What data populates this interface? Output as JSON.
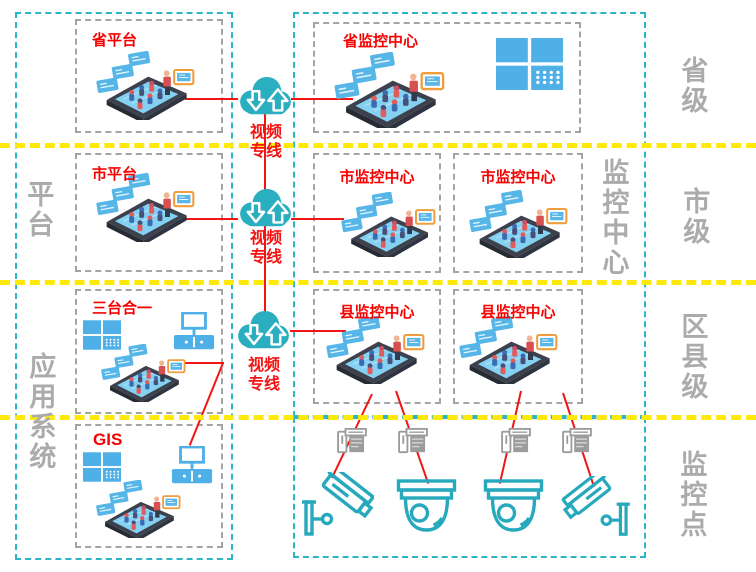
{
  "platform_column": {
    "boxes": [
      {
        "title": "省平台"
      },
      {
        "title": "市平台"
      },
      {
        "title": "三台合一"
      },
      {
        "title": "GIS"
      }
    ]
  },
  "monitoring_column": {
    "boxes": [
      {
        "title": "省监控中心"
      },
      {
        "title": "市监控中心"
      },
      {
        "title": "市监控中心"
      },
      {
        "title": "县监控中心"
      },
      {
        "title": "县监控中心"
      }
    ]
  },
  "video_links": [
    {
      "line1": "视频",
      "line2": "专线"
    },
    {
      "line1": "视频",
      "line2": "专线"
    },
    {
      "line1": "视频",
      "line2": "专线"
    }
  ],
  "side_labels": {
    "platform": "平台",
    "application_system": "应用系统",
    "monitoring_center": "监控中心",
    "province_level": "省级",
    "city_level": "市级",
    "district_county_level": "区县级",
    "monitoring_point": "监控点"
  },
  "icons": {
    "cloud": "cloud-upload-download-icon",
    "phone": "isometric-phone-meeting-illustration",
    "video_wall": "video-wall-grid-icon",
    "desk_tv": "tv-with-cabinet-icon",
    "nvr": "nvr-server-icon",
    "dome_camera": "dome-camera-icon",
    "bullet_camera": "bullet-camera-icon"
  },
  "colors": {
    "teal_border": "#2cb5c6",
    "gray_border": "#a4a4a4",
    "yellow_divider": "#ffe90a",
    "red_line": "#f31414",
    "title_red": "#f70000",
    "label_gray": "#ababab",
    "icon_blue": "#4fb0e8",
    "cloud_teal": "#2aaec0",
    "camera_teal": "#27a9bd",
    "nvr_gray": "#9c9c9c"
  }
}
